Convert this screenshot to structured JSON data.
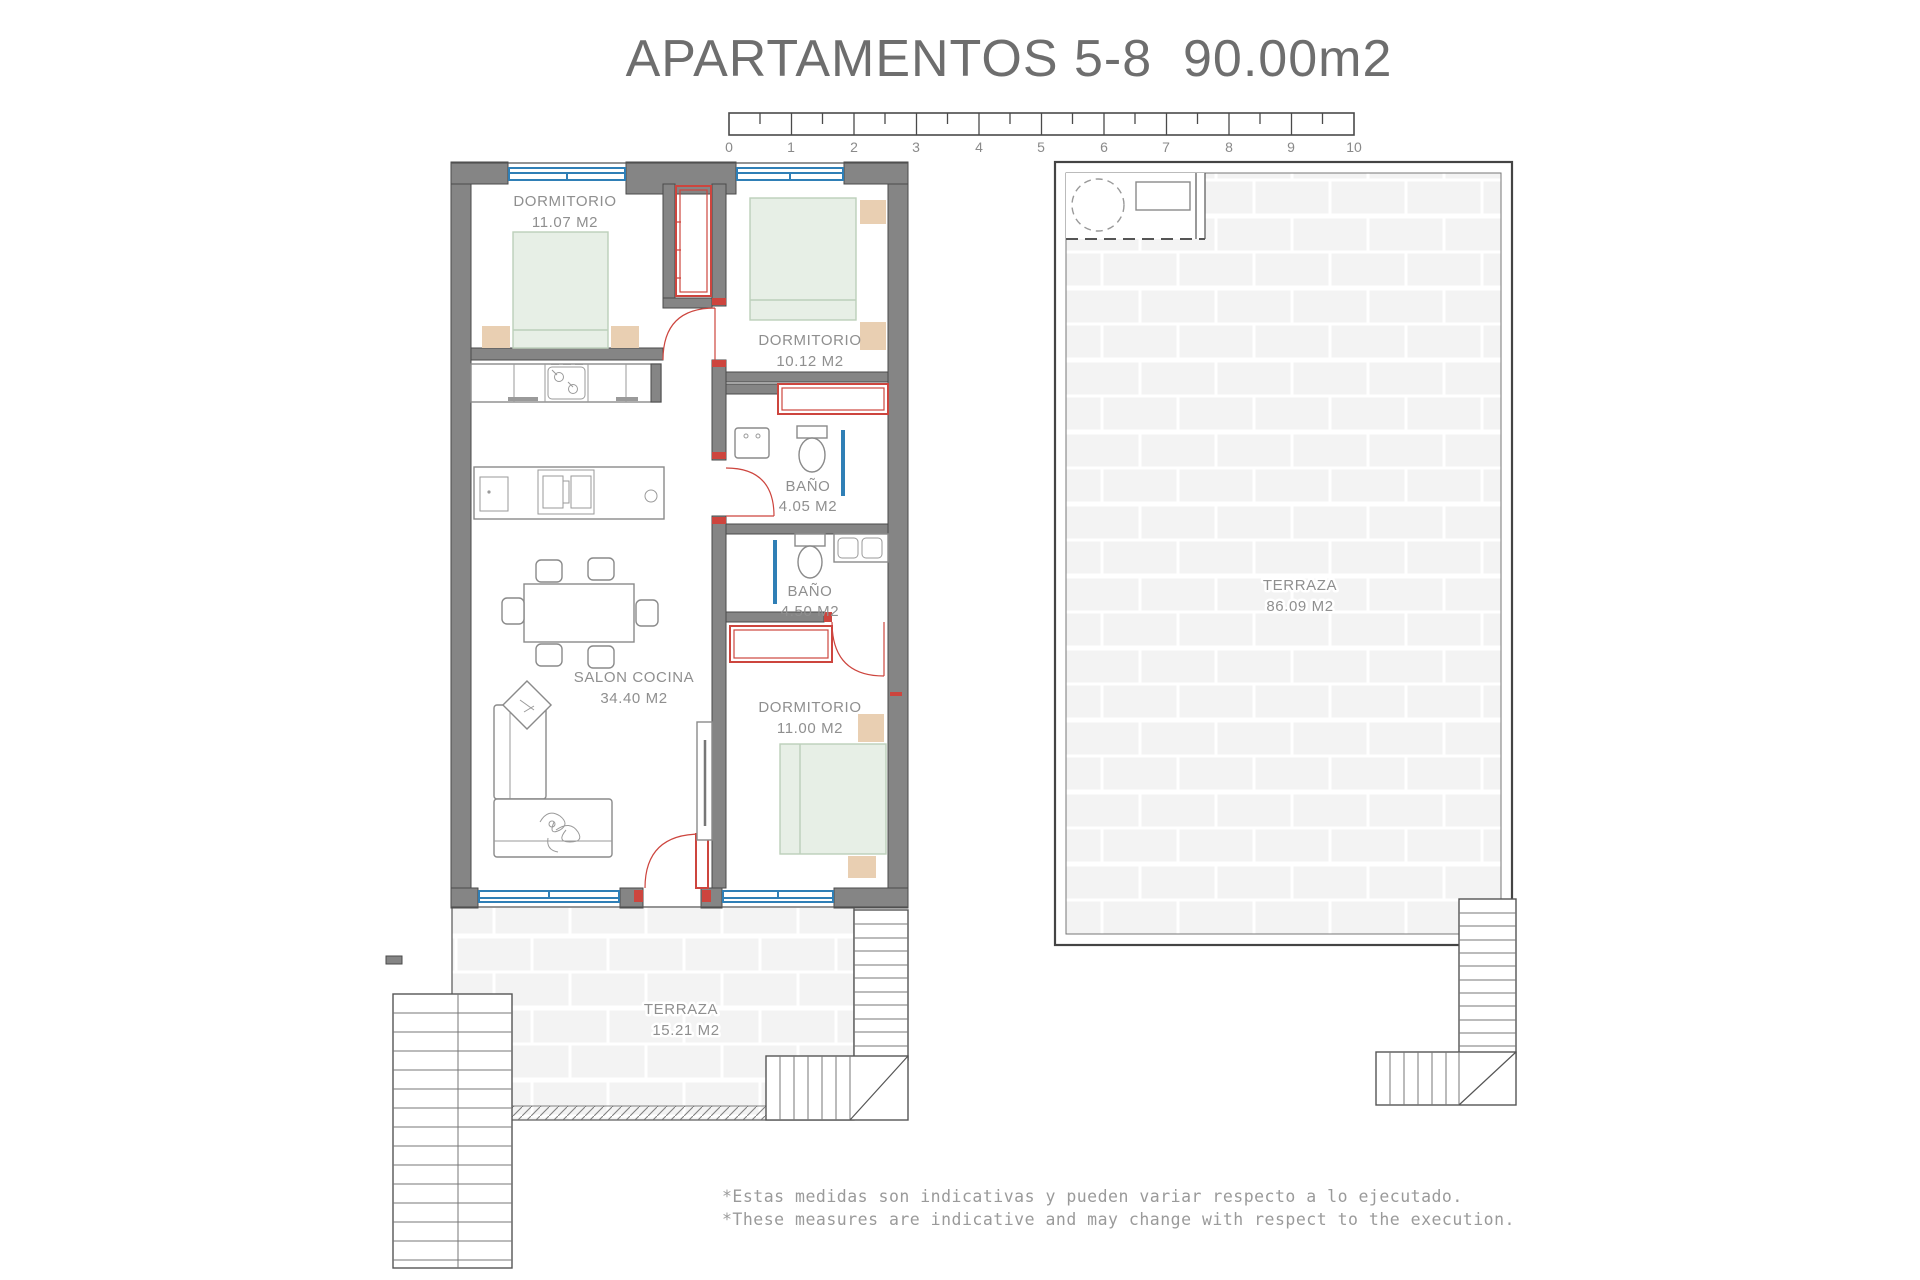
{
  "title": "APARTAMENTOS 5-8  90.00m2",
  "scale_bar": {
    "unit_labels": [
      "0",
      "1",
      "2",
      "3",
      "4",
      "5",
      "6",
      "7",
      "8",
      "9",
      "10"
    ]
  },
  "rooms": {
    "dormitorio1": {
      "name": "DORMITORIO",
      "area": "11.07 M2"
    },
    "dormitorio2": {
      "name": "DORMITORIO",
      "area": "10.12 M2"
    },
    "bano1": {
      "name": "BAÑO",
      "area": "4.05 M2"
    },
    "bano2": {
      "name": "BAÑO",
      "area": "4.50 M2"
    },
    "salon": {
      "name": "SALON COCINA",
      "area": "34.40 M2"
    },
    "dormitorio3": {
      "name": "DORMITORIO",
      "area": "11.00 M2"
    },
    "terraza_small": {
      "name": "TERRAZA",
      "area": "15.21 M2"
    },
    "terraza_large": {
      "name": "TERRAZA",
      "area": "86.09 M2"
    }
  },
  "footnotes": {
    "line_es": "*Estas medidas son indicativas y pueden variar respecto a lo ejecutado.",
    "line_en": "*These measures are indicative and may change with respect to the execution."
  },
  "colors": {
    "wall_gray": "#858585",
    "accent_red": "#cd453e",
    "window_blue": "#2f7fb6",
    "bed_green": "#e7efe6",
    "wood_tan": "#e9cfb2",
    "text_gray": "#8f8f8f"
  }
}
